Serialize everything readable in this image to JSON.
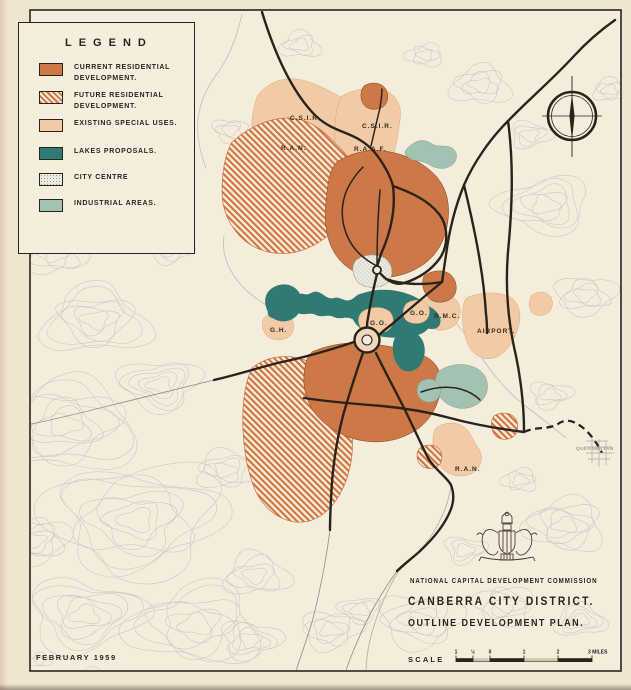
{
  "sheet": {
    "date_stamp": "FEBRUARY 1959"
  },
  "legend": {
    "title": "LEGEND",
    "items": [
      {
        "id": "current-residential",
        "label": "CURRENT RESIDENTIAL DEVELOPMENT.",
        "color": "#cc7947",
        "style": "solid"
      },
      {
        "id": "future-residential",
        "label": "FUTURE RESIDENTIAL DEVELOPMENT.",
        "color": "#cd7240",
        "style": "diagonal-hatch"
      },
      {
        "id": "existing-special-uses",
        "label": "EXISTING SPECIAL USES.",
        "color": "#f2cba6",
        "style": "solid"
      },
      {
        "id": "lakes-proposals",
        "label": "LAKES PROPOSALS.",
        "color": "#2f7a72",
        "style": "solid"
      },
      {
        "id": "city-centre",
        "label": "CITY CENTRE",
        "color": "#ebebdf",
        "style": "stipple"
      },
      {
        "id": "industrial-areas",
        "label": "INDUSTRIAL AREAS.",
        "color": "#a3c2b2",
        "style": "solid"
      }
    ]
  },
  "title_block": {
    "agency": "NATIONAL CAPITAL DEVELOPMENT COMMISSION",
    "title": "CANBERRA  CITY  DISTRICT.",
    "subtitle": "OUTLINE  DEVELOPMENT  PLAN.",
    "scale_label": "SCALE",
    "scale_ticks": [
      "1",
      "½",
      "0",
      "1",
      "2",
      "3 MILES"
    ]
  },
  "map_labels": [
    {
      "text": "C.S.I.R.",
      "x": 290,
      "y": 120
    },
    {
      "text": "C.S.I.R.",
      "x": 362,
      "y": 128
    },
    {
      "text": "R.A.N.",
      "x": 281,
      "y": 150
    },
    {
      "text": "R.A.A.F.",
      "x": 354,
      "y": 151
    },
    {
      "text": "G.H.",
      "x": 270,
      "y": 332
    },
    {
      "text": "G.O.",
      "x": 370,
      "y": 325
    },
    {
      "text": "G.O.",
      "x": 410,
      "y": 315
    },
    {
      "text": "R.M.C.",
      "x": 434,
      "y": 318
    },
    {
      "text": "AIRPORT.",
      "x": 477,
      "y": 333
    },
    {
      "text": "R.A.N.",
      "x": 455,
      "y": 471
    },
    {
      "text": "QUEANBEYAN",
      "x": 576,
      "y": 450,
      "muted": true
    }
  ],
  "icons": {
    "compass": "north-arrow-compass",
    "crest": "commission-coat-of-arms"
  },
  "palette": {
    "paper": "#efe5d1",
    "map_background": "#f5eddc",
    "ink": "#2b231b",
    "contour": "#b3abab",
    "current_residential": "#cc7947",
    "hatch_line": "#cd7240",
    "existing_special_uses": "#f2cba6",
    "lakes": "#2f7a72",
    "industrial": "#a3c2b2",
    "city_centre": "#ebebdf",
    "muted_text": "#a39a8c"
  }
}
